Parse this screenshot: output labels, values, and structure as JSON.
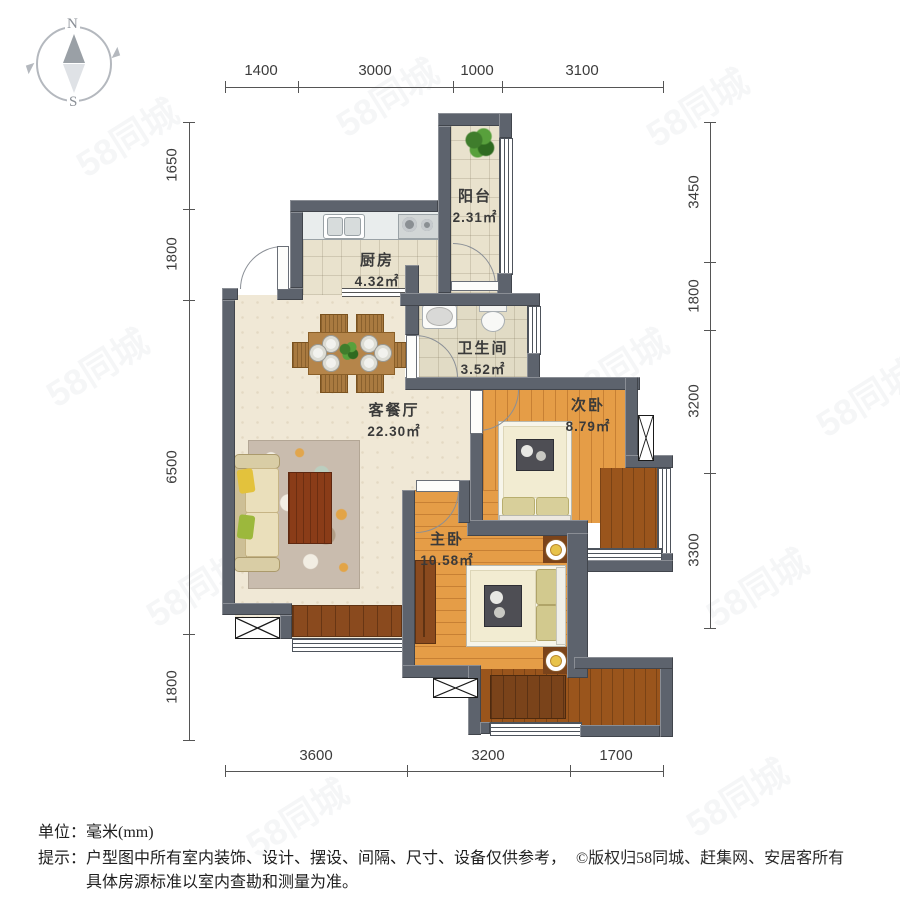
{
  "compass": {
    "north": "N",
    "south": "S"
  },
  "dimensions": {
    "top": [
      "1400",
      "3000",
      "1000",
      "3100"
    ],
    "left": [
      "1650",
      "1800",
      "6500",
      "1800"
    ],
    "right": [
      "3450",
      "1800",
      "3200",
      "3300"
    ],
    "bottom": [
      "3600",
      "3200",
      "1700"
    ]
  },
  "rooms": [
    {
      "name": "阳台",
      "area": "2.31㎡"
    },
    {
      "name": "厨房",
      "area": "4.32㎡"
    },
    {
      "name": "卫生间",
      "area": "3.52㎡"
    },
    {
      "name": "客餐厅",
      "area": "22.30㎡"
    },
    {
      "name": "次卧",
      "area": "8.79㎡"
    },
    {
      "name": "主卧",
      "area": "10.58㎡"
    }
  ],
  "footer": {
    "unit_label": "单位：",
    "unit_value": "毫米(mm)",
    "tip_label": "提示：",
    "tip_line1": "户型图中所有室内装饰、设计、摆设、间隔、尺寸、设备仅供参考，",
    "tip_line2": "具体房源标准以室内查勘和测量为准。",
    "copyright": "©版权归58同城、赶集网、安居客所有"
  },
  "watermark": "58同城",
  "colors": {
    "wall": "#5d636d",
    "tile": "#e9e2cd",
    "living": "#f0e8d6",
    "wood": "#e59d47",
    "wood_dark": "#9a551c",
    "furniture_dark": "#7a431a",
    "table_wood": "#b5854a",
    "bed_cream": "#f2ecd2",
    "dim_line": "#555555",
    "label_text": "#3a3a3a"
  }
}
